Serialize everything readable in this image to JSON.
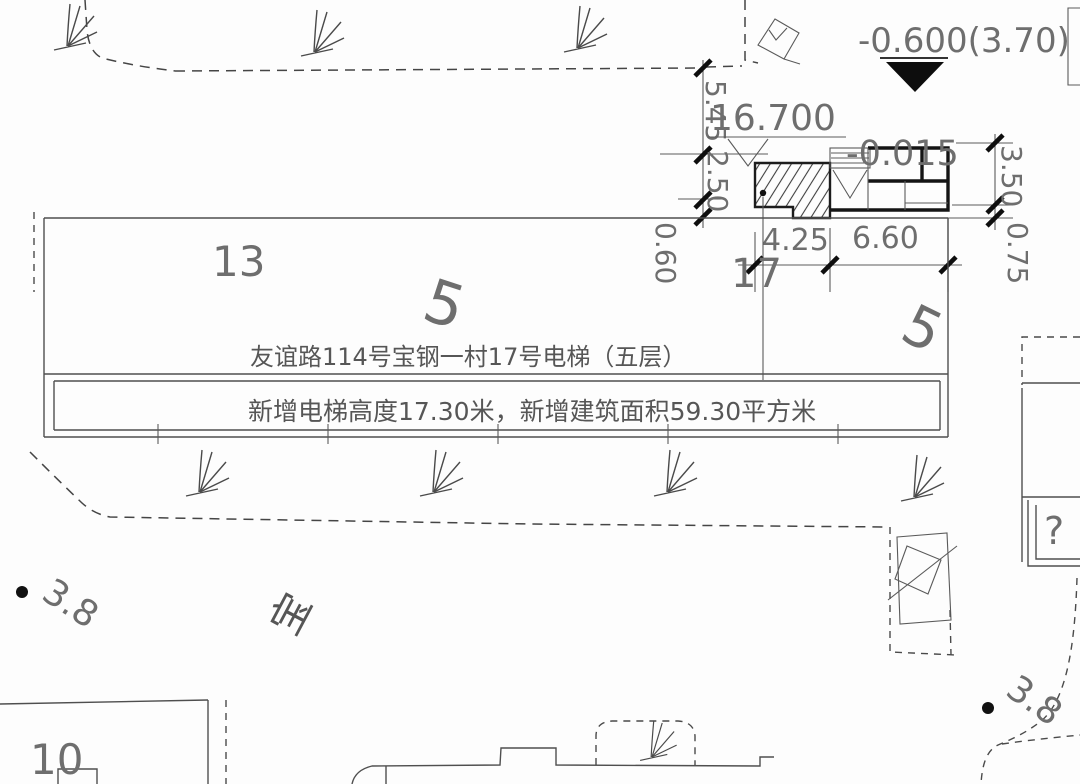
{
  "drawing_title": "residential site plan - elevator addition",
  "colors": {
    "ink": "#4f4f4f",
    "thick_ink": "#141414",
    "text": "#6e6e6e",
    "marker_fill": "#0d0d0d"
  },
  "elevation_markers": {
    "site_datum": "-0.600(3.70)",
    "elevator_roof": "16.700",
    "entrance_level": "-0.015"
  },
  "dimensions": {
    "left_v_top": "5.45",
    "left_v_mid": "2.50",
    "left_v_bottom": "0.60",
    "bottom_h_left": "4.25",
    "bottom_h_right": "6.60",
    "right_v_top": "3.50",
    "right_v_bottom": "0.75"
  },
  "building_labels": {
    "block_13": "13",
    "unit_17": "17",
    "block_10": "10",
    "road_5_left": "5",
    "road_5_right": "5",
    "unknown_mark": "?"
  },
  "spot_elevations": {
    "left": "3.8",
    "right": "3.8"
  },
  "estate_char": "宝",
  "annotations": {
    "line1": "友谊路114号宝钢一村17号电梯（五层）",
    "line2": "新增电梯高度17.30米，新增建筑面积59.30平方米"
  }
}
